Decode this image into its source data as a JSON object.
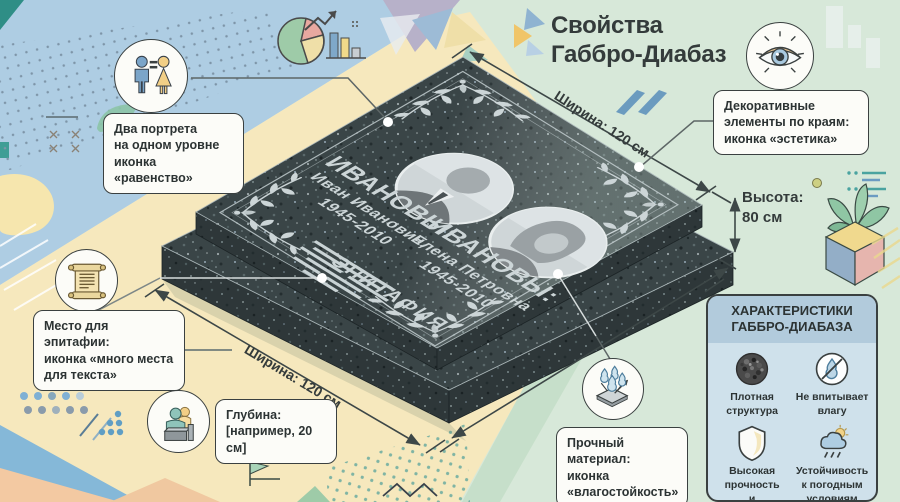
{
  "title": {
    "lines": [
      "Свойства",
      "Габбро-Диабаз"
    ]
  },
  "dimensions": {
    "width_top": "Ширина: 120 см",
    "width_bottom": "Ширина: 120 см",
    "height_lines": [
      "Высота:",
      "80 см"
    ]
  },
  "monument": {
    "husband": {
      "surname": "ИВАНОВЫ:",
      "name": "Иван Иванович,",
      "years": "1945-2010"
    },
    "wife": {
      "surname": "ИВАНОВЫ:",
      "name": "Елена Петровна",
      "years": "1945-2010"
    },
    "epitaph_label": "ЭПИТАФИЯ"
  },
  "callouts": {
    "portraits": {
      "icon": "man-equals-woman-icon",
      "lines": [
        "Два портрета",
        "на одном уровне",
        "иконка «равенство»"
      ]
    },
    "epitaph": {
      "icon": "scroll-icon",
      "lines": [
        "Место для эпитафии:",
        "иконка «много места",
        "для текста»"
      ]
    },
    "depth": {
      "icon": "speaker-podium-icon",
      "lines": [
        "Глубина:",
        "[например, 20 см]"
      ]
    },
    "decor": {
      "icon": "eye-icon",
      "lines": [
        "Декоративные",
        "элементы по краям:",
        "иконка «эстетика»"
      ]
    },
    "material": {
      "icon": "water-drops-icon",
      "lines": [
        "Прочный материал:",
        "иконка",
        "«влагостойкость»"
      ]
    }
  },
  "panel": {
    "title_lines": [
      "ХАРАКТЕРИСТИКИ",
      "ГАББРО-ДИАБАЗА"
    ],
    "items": [
      {
        "icon": "dense-structure-icon",
        "label_lines": [
          "Плотная",
          "структура",
          ""
        ]
      },
      {
        "icon": "no-absorption-icon",
        "label_lines": [
          "Не впитывает",
          "влагу",
          ""
        ]
      },
      {
        "icon": "shield-icon",
        "label_lines": [
          "Высокая",
          "прочность",
          "и долговечность"
        ]
      },
      {
        "icon": "weather-resistant-icon",
        "label_lines": [
          "Устойчивость",
          "к погодным",
          "условиям"
        ]
      }
    ]
  },
  "colors": {
    "stone": "#3a4547",
    "background_blue": "#aecde3",
    "background_yellow": "#f6e8bd",
    "background_green": "#d7e8d9",
    "panel_blue": "#cfe1eb",
    "engraving": "#ccd5d7",
    "accent_teal": "#4aa3a0",
    "accent_steel_blue": "#7fa7c7",
    "accent_sand": "#f2cf86"
  }
}
